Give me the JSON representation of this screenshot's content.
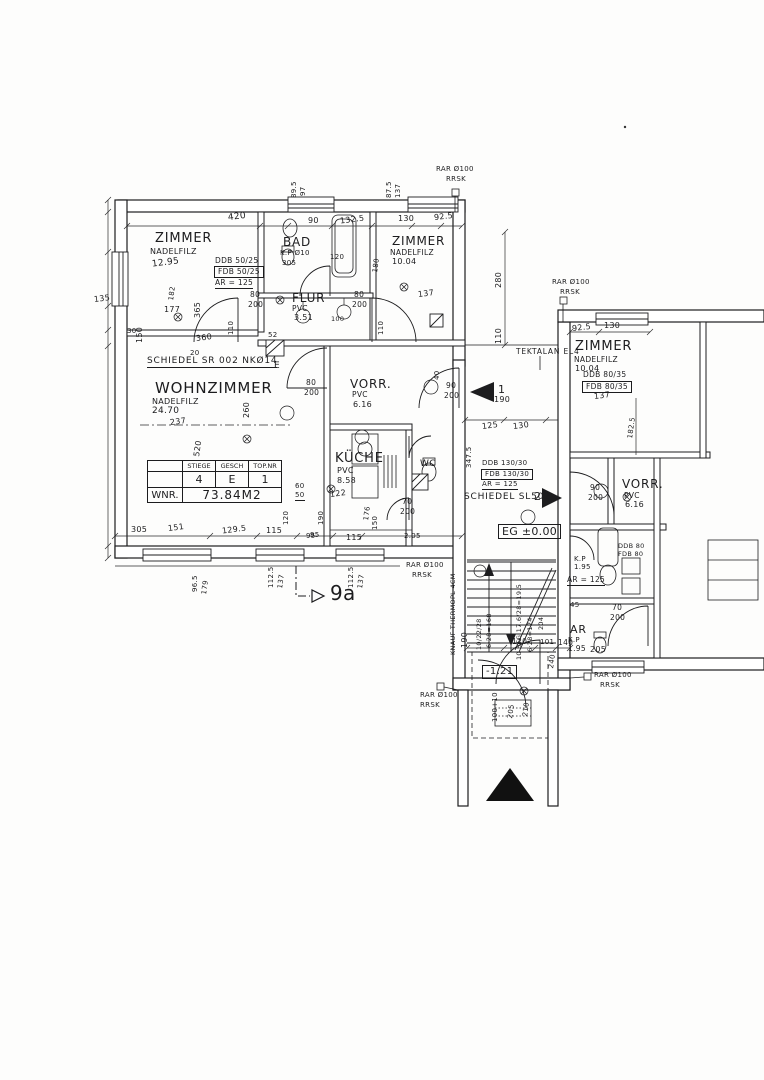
{
  "rooms": {
    "zimmer_nw": {
      "name": "ZIMMER",
      "finish": "NADELFILZ",
      "area": "12.95"
    },
    "bad": {
      "name": "BAD",
      "note": "K.P Ø10"
    },
    "zimmer_ne": {
      "name": "ZIMMER",
      "finish": "NADELFILZ",
      "area": "10.04"
    },
    "flur": {
      "name": "FLUR",
      "finish": "PVC",
      "area": "3.51"
    },
    "wohnzimmer": {
      "name": "WOHNZIMMER",
      "finish": "NADELFILZ",
      "area": "24.70"
    },
    "vorraum": {
      "name": "VORR.",
      "finish": "PVC",
      "area": "6.16"
    },
    "kueche": {
      "name": "KÜCHE",
      "finish": "PVC",
      "area": "8.58"
    },
    "wc": {
      "name": "WC"
    },
    "zimmer_e": {
      "name": "ZIMMER",
      "finish": "NADELFILZ",
      "area": "10.04"
    },
    "vorraum_e": {
      "name": "VORR.",
      "finish": "PVC",
      "area": "6.16"
    },
    "ar_e": {
      "name": "AR",
      "note": "K.P",
      "height": "1.95"
    }
  },
  "bath_e": {
    "kp": "K.P",
    "h": "1.95",
    "ar": "AR = 125"
  },
  "info_table": {
    "col1": "STIEGE",
    "col2": "GESCH",
    "col3": "TOP.NR",
    "v1": "4",
    "v2": "E",
    "v3": "1",
    "wnr": "WNR.",
    "area": "73.84M2"
  },
  "levels": {
    "eg": "EG ±0.00",
    "entry": "-1.21"
  },
  "annotations": {
    "schiedel1": "SCHIEDEL SR 002 NKØ14",
    "schiedel2": "SCHIEDEL SL502",
    "tektalan": "TEKTALAN EL4",
    "knauf": "KNAUF THERMOPL 4CM",
    "rar": "RAR Ø100",
    "rrsk": "RRSK",
    "marker1": "1",
    "marker2": "2",
    "section": "9a",
    "chimney_e": "E",
    "ddb_nw1": "DDB 50/25",
    "ddb_nw2": "FDB 50/25",
    "ddb_nw3": "AR = 125",
    "ddb_mid1": "DDB 130/30",
    "ddb_mid2": "FDB 130/30",
    "ddb_mid3": "AR = 125",
    "ddb_e1": "DDB 80/35",
    "ddb_e2": "FDB 80/35",
    "ddb_r1": "DDB 80",
    "ddb_r2": "FDB 80",
    "stair1": "10/22/28",
    "stair2": "6·28=168",
    "stair3": "10 STG 17.6/28=19.5",
    "stair4": "6·28=124",
    "stair5": "204"
  },
  "dims": {
    "top": [
      "420",
      "90",
      "132.5",
      "130",
      "92.5"
    ],
    "top_v": [
      "89.5",
      "97",
      "87.5",
      "137"
    ],
    "left": [
      "135",
      "150",
      "365",
      "177",
      "30",
      "360",
      "20",
      "182"
    ],
    "bad": [
      "305",
      "120",
      "180"
    ],
    "ne": [
      "280",
      "110",
      "137"
    ],
    "flur": [
      "80",
      "200",
      "80",
      "200",
      "110",
      "110",
      "100",
      "52"
    ],
    "wz": [
      "237",
      "260",
      "520",
      "80",
      "200"
    ],
    "vorr": [
      "90",
      "200",
      "40"
    ],
    "mid": [
      "190",
      "125",
      "130",
      "347.5"
    ],
    "kueche": [
      "122",
      "60",
      "50",
      "120",
      "190",
      "176",
      "150",
      "95",
      "115",
      "70",
      "200",
      "2.05"
    ],
    "stairs": [
      "190",
      "120",
      "101",
      "140",
      "240"
    ],
    "bottom": [
      "305",
      "151",
      "129.5",
      "115",
      "95"
    ],
    "bottom_v": [
      "96.5",
      "179",
      "112.5",
      "137",
      "112.5",
      "137"
    ],
    "right_top": [
      "92.5",
      "130",
      "137",
      "182.5"
    ],
    "right_rooms": [
      "90",
      "200",
      "45",
      "70",
      "200",
      "205"
    ],
    "porch": [
      "100+10",
      "205",
      "210"
    ]
  }
}
